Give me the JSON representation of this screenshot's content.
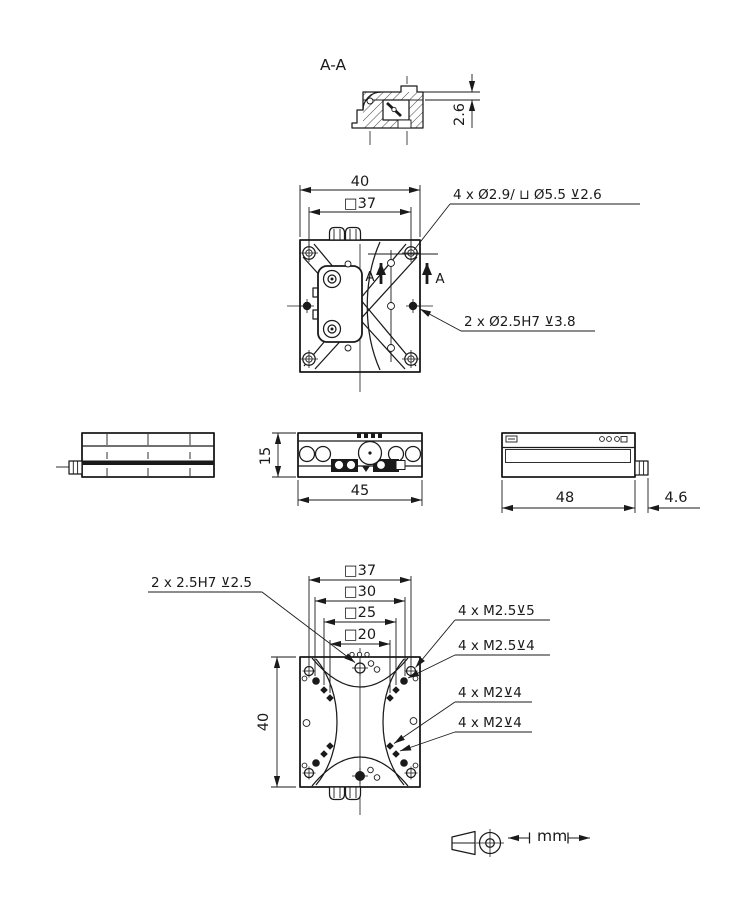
{
  "drawing": {
    "section": {
      "label": "A-A",
      "dim_step": "2.6"
    },
    "top_view": {
      "dim_width": "40",
      "dim_square": "□37",
      "note_cbore": "4 x Ø2.9/ ⊔ Ø5.5 ⊻2.6",
      "note_dowel": "2 x Ø2.5H7 ⊻3.8",
      "cut_arrow_left": "A",
      "cut_arrow_right": "A"
    },
    "front_view": {
      "dim_height": "15",
      "dim_width": "45"
    },
    "side_view": {
      "dim_length": "48",
      "dim_tab": "4.6"
    },
    "bottom_view": {
      "dim_sq37": "□37",
      "dim_sq30": "□30",
      "dim_sq25": "□25",
      "dim_sq20": "□20",
      "dim_height": "40",
      "note_dowel": "2 x 2.5H7 ⊻2.5",
      "note_m25_5": "4 x M2.5⊻5",
      "note_m25_4": "4 x M2.5⊻4",
      "note_m2_4a": "4 x M2⊻4",
      "note_m2_4b": "4 x M2⊻4"
    },
    "footer": {
      "units": "mm"
    },
    "colors": {
      "ink": "#1a1a1a",
      "background": "#ffffff"
    }
  }
}
